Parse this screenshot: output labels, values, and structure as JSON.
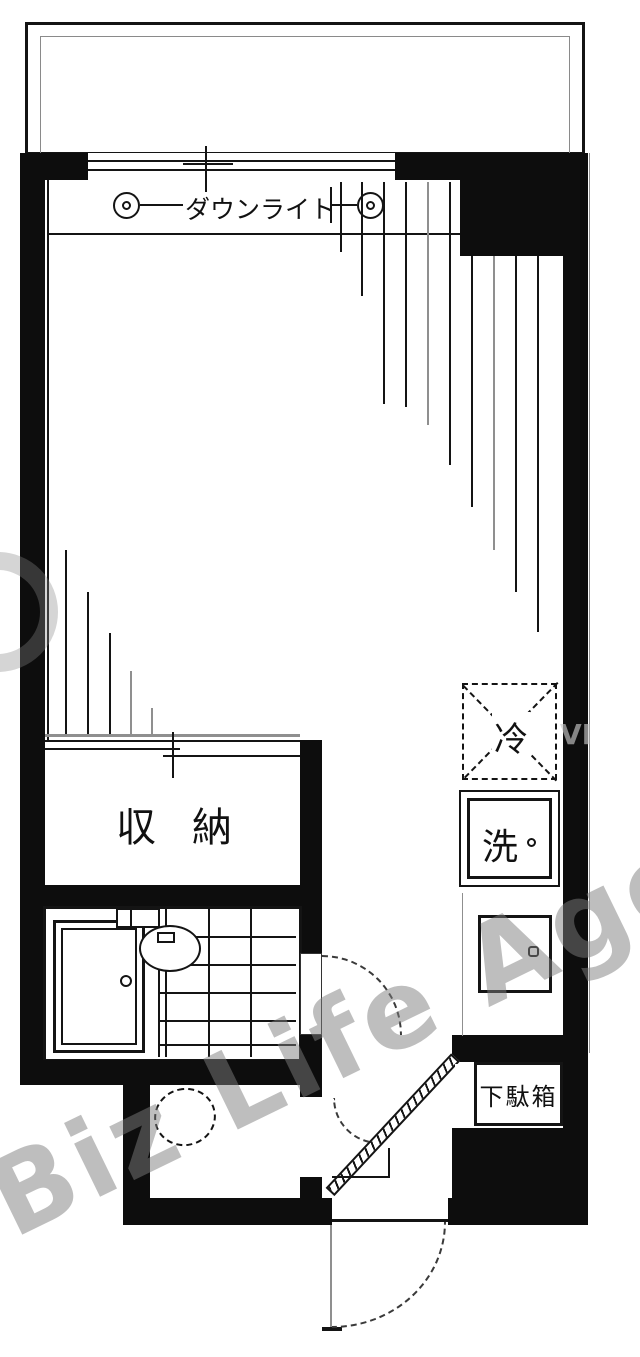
{
  "plan": {
    "type": "japanese-apartment-floor-plan"
  },
  "labels": {
    "downlight": "ダウンライト",
    "storage": "収納",
    "refrigerator": "冷",
    "washer": "洗",
    "shoe_box": "下駄箱"
  },
  "watermark": {
    "main": "Biz Life Agent",
    "side": "VI"
  },
  "colors": {
    "wall": "#0d0d0d",
    "line": "#141414",
    "gray_line": "#8f8f8f",
    "watermark": "rgba(125,125,125,0.5)"
  }
}
